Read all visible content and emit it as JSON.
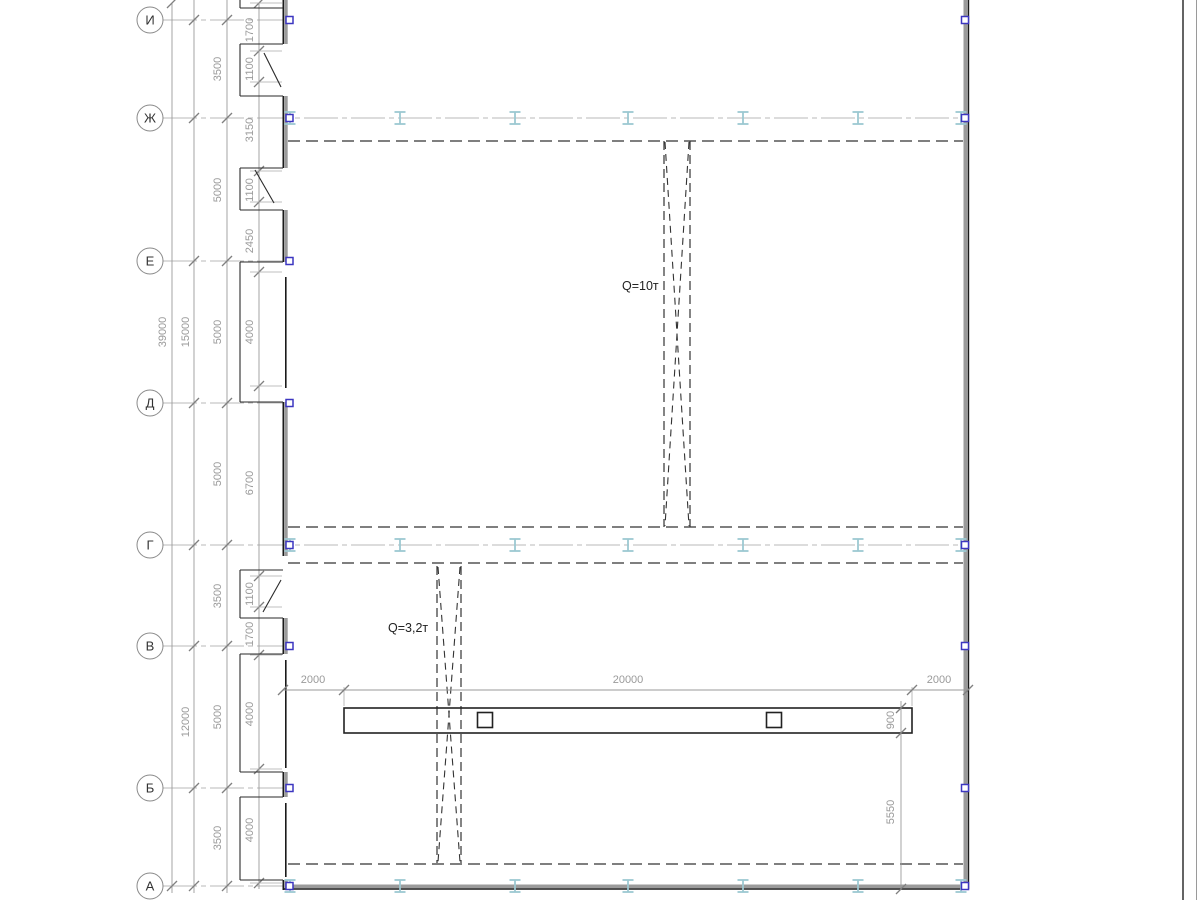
{
  "drawing": {
    "type": "structural-floor-plan",
    "axes": [
      "И",
      "Ж",
      "Е",
      "Д",
      "Г",
      "В",
      "Б",
      "А"
    ],
    "dims": {
      "overall": "39000",
      "groups": [
        "15000",
        "12000"
      ],
      "axis_spacing": [
        "3500",
        "5000",
        "5000",
        "5000",
        "3500",
        "5000",
        "3500"
      ],
      "inner": [
        "1700",
        "1100",
        "3150",
        "1100",
        "2450",
        "4000",
        "6700",
        "1100",
        "1700",
        "4000",
        "4000"
      ],
      "bottom": [
        "2000",
        "20000",
        "2000"
      ],
      "beam_height": "900",
      "beam_to_wall": "5550"
    },
    "cranes": [
      {
        "label": "Q=10т"
      },
      {
        "label": "Q=3,2т"
      }
    ],
    "colors": {
      "wall": "#1a1a1a",
      "dimension": "#9a9a9a",
      "axis_line": "#b8b8b8",
      "steel_column": "#9cc8d2",
      "wall_anchor": "#3c36c0"
    }
  }
}
